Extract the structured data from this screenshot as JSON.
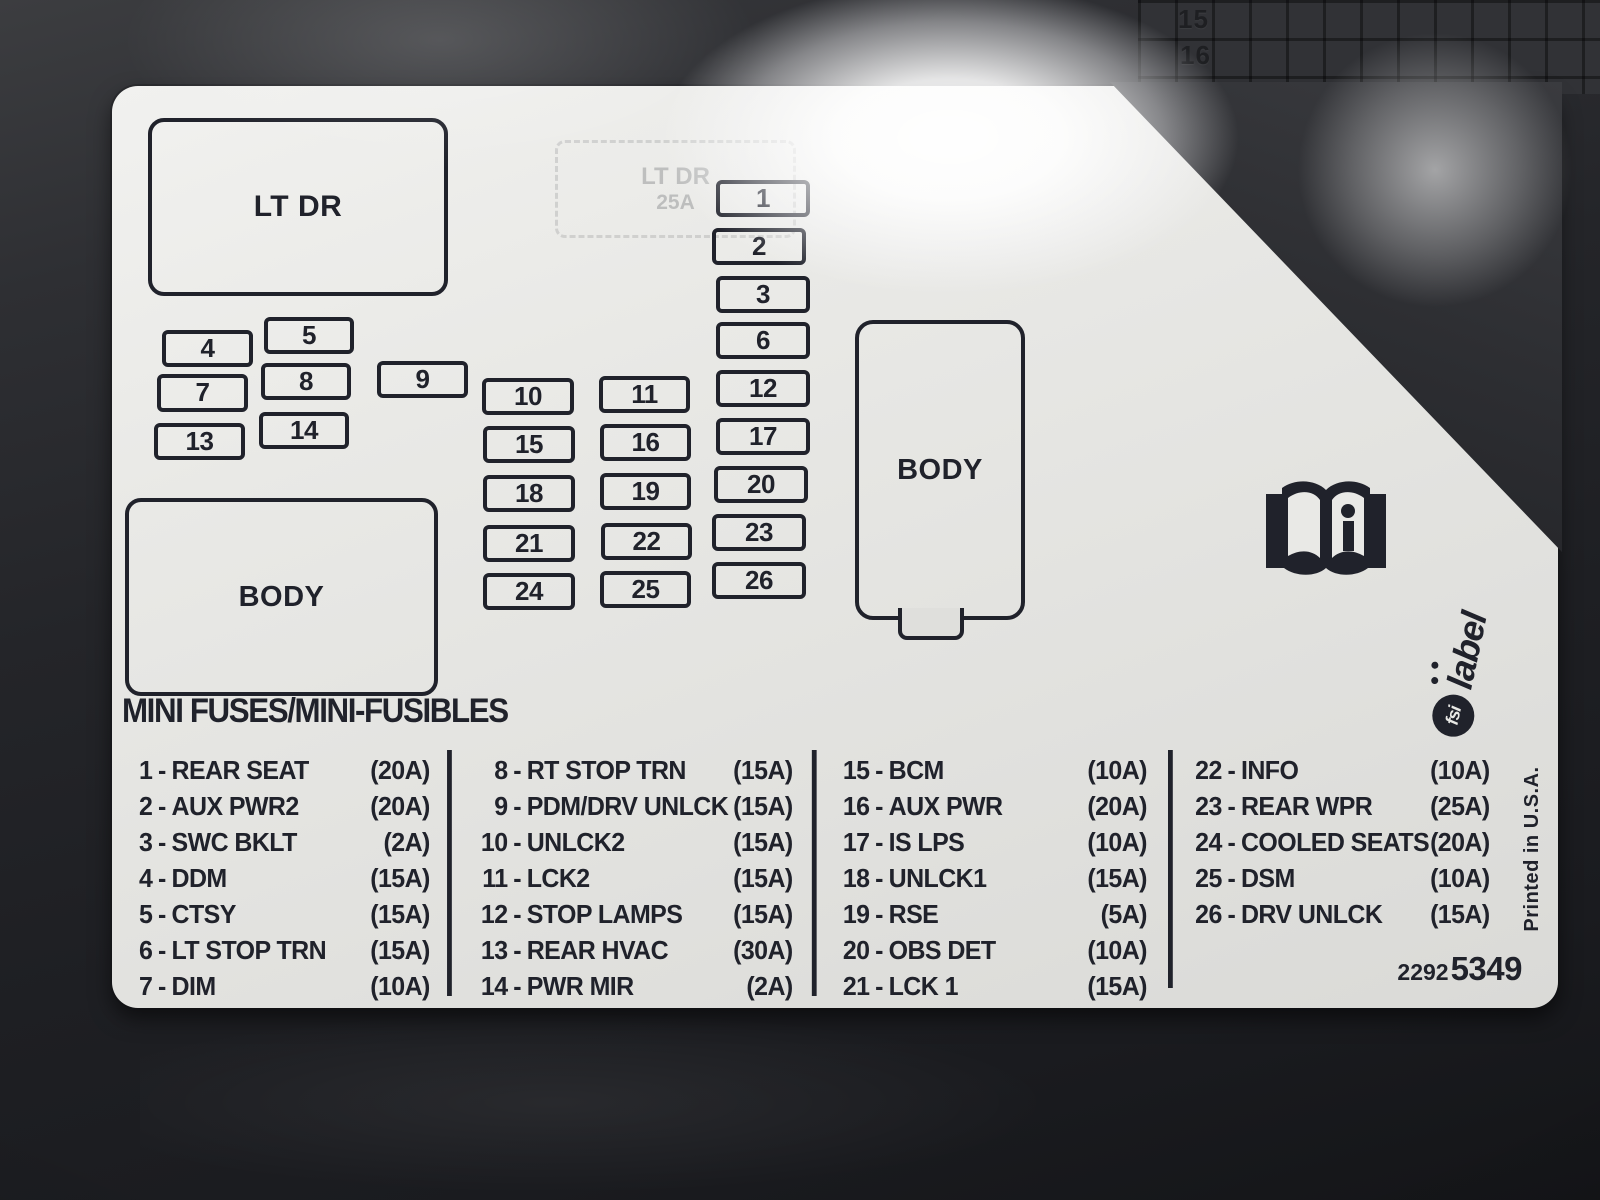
{
  "photo": {
    "surface_grid_numbers": [
      "15",
      "16"
    ],
    "label": {
      "title": "MINI FUSES/MINI-FUSIBLES",
      "lt_dr_box": "LT DR",
      "body_box_left": "BODY",
      "body_box_right": "BODY",
      "ghost_imprint": {
        "line1": "LT DR",
        "line2": "25A"
      },
      "fuse_slots": [
        {
          "n": "1",
          "x": 604,
          "y": 94,
          "w": 86,
          "h": 29
        },
        {
          "n": "2",
          "x": 600,
          "y": 142,
          "w": 86,
          "h": 29
        },
        {
          "n": "3",
          "x": 604,
          "y": 190,
          "w": 86,
          "h": 29
        },
        {
          "n": "4",
          "x": 50,
          "y": 244,
          "w": 83,
          "h": 29
        },
        {
          "n": "5",
          "x": 152,
          "y": 231,
          "w": 82,
          "h": 29
        },
        {
          "n": "6",
          "x": 604,
          "y": 236,
          "w": 86,
          "h": 29
        },
        {
          "n": "7",
          "x": 45,
          "y": 288,
          "w": 83,
          "h": 30
        },
        {
          "n": "8",
          "x": 149,
          "y": 277,
          "w": 82,
          "h": 29
        },
        {
          "n": "9",
          "x": 265,
          "y": 275,
          "w": 83,
          "h": 29
        },
        {
          "n": "10",
          "x": 370,
          "y": 292,
          "w": 84,
          "h": 29
        },
        {
          "n": "11",
          "x": 487,
          "y": 290,
          "w": 83,
          "h": 29
        },
        {
          "n": "12",
          "x": 604,
          "y": 284,
          "w": 86,
          "h": 29
        },
        {
          "n": "13",
          "x": 42,
          "y": 337,
          "w": 83,
          "h": 29
        },
        {
          "n": "14",
          "x": 147,
          "y": 326,
          "w": 82,
          "h": 29
        },
        {
          "n": "15",
          "x": 371,
          "y": 340,
          "w": 84,
          "h": 29
        },
        {
          "n": "16",
          "x": 488,
          "y": 338,
          "w": 83,
          "h": 29
        },
        {
          "n": "17",
          "x": 604,
          "y": 332,
          "w": 86,
          "h": 29
        },
        {
          "n": "18",
          "x": 371,
          "y": 389,
          "w": 84,
          "h": 29
        },
        {
          "n": "19",
          "x": 488,
          "y": 387,
          "w": 83,
          "h": 29
        },
        {
          "n": "20",
          "x": 602,
          "y": 380,
          "w": 86,
          "h": 29
        },
        {
          "n": "21",
          "x": 371,
          "y": 439,
          "w": 84,
          "h": 29
        },
        {
          "n": "22",
          "x": 489,
          "y": 437,
          "w": 83,
          "h": 29
        },
        {
          "n": "23",
          "x": 600,
          "y": 428,
          "w": 86,
          "h": 29
        },
        {
          "n": "24",
          "x": 371,
          "y": 487,
          "w": 84,
          "h": 29
        },
        {
          "n": "25",
          "x": 488,
          "y": 485,
          "w": 83,
          "h": 29
        },
        {
          "n": "26",
          "x": 600,
          "y": 476,
          "w": 86,
          "h": 29
        }
      ],
      "legend": {
        "separator": "-",
        "columns": [
          {
            "entries": [
              {
                "num": "1",
                "name": "REAR SEAT",
                "amp": "(20A)"
              },
              {
                "num": "2",
                "name": "AUX PWR2",
                "amp": "(20A)"
              },
              {
                "num": "3",
                "name": "SWC BKLT",
                "amp": "(2A)"
              },
              {
                "num": "4",
                "name": "DDM",
                "amp": "(15A)"
              },
              {
                "num": "5",
                "name": "CTSY",
                "amp": "(15A)"
              },
              {
                "num": "6",
                "name": "LT STOP TRN",
                "amp": "(15A)"
              },
              {
                "num": "7",
                "name": "DIM",
                "amp": "(10A)"
              }
            ]
          },
          {
            "entries": [
              {
                "num": "8",
                "name": "RT STOP TRN",
                "amp": "(15A)"
              },
              {
                "num": "9",
                "name": "PDM/DRV UNLCK",
                "amp": "(15A)"
              },
              {
                "num": "10",
                "name": "UNLCK2",
                "amp": "(15A)"
              },
              {
                "num": "11",
                "name": "LCK2",
                "amp": "(15A)"
              },
              {
                "num": "12",
                "name": "STOP LAMPS",
                "amp": "(15A)"
              },
              {
                "num": "13",
                "name": "REAR HVAC",
                "amp": "(30A)"
              },
              {
                "num": "14",
                "name": "PWR MIR",
                "amp": "(2A)"
              }
            ]
          },
          {
            "entries": [
              {
                "num": "15",
                "name": "BCM",
                "amp": "(10A)"
              },
              {
                "num": "16",
                "name": "AUX PWR",
                "amp": "(20A)"
              },
              {
                "num": "17",
                "name": "IS LPS",
                "amp": "(10A)"
              },
              {
                "num": "18",
                "name": "UNLCK1",
                "amp": "(15A)"
              },
              {
                "num": "19",
                "name": "RSE",
                "amp": "(5A)"
              },
              {
                "num": "20",
                "name": "OBS DET",
                "amp": "(10A)"
              },
              {
                "num": "21",
                "name": "LCK 1",
                "amp": "(15A)"
              }
            ]
          },
          {
            "entries": [
              {
                "num": "22",
                "name": "INFO",
                "amp": "(10A)"
              },
              {
                "num": "23",
                "name": "REAR WPR",
                "amp": "(25A)"
              },
              {
                "num": "24",
                "name": "COOLED SEATS",
                "amp": "(20A)"
              },
              {
                "num": "25",
                "name": "DSM",
                "amp": "(10A)"
              },
              {
                "num": "26",
                "name": "DRV UNLCK",
                "amp": "(15A)"
              }
            ]
          }
        ]
      },
      "brand": {
        "circle_text": "fsi",
        "word": "label"
      },
      "printed_in": "Printed in U.S.A.",
      "part_number_small": "2292",
      "part_number_large": "5349",
      "manual_icon": "owner-manual-book-icon"
    }
  }
}
